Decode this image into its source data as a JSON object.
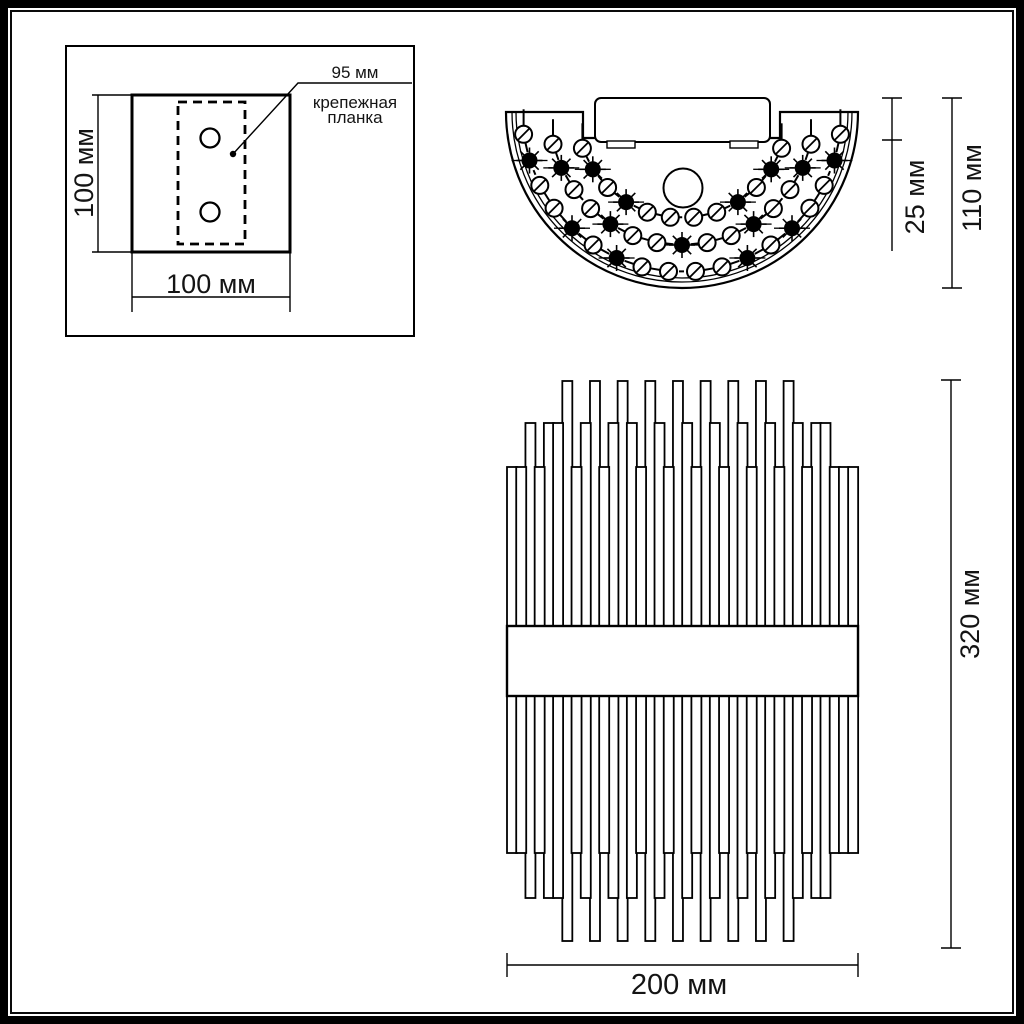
{
  "page": {
    "background": "#ffffff",
    "line_color": "#000000"
  },
  "mounting_plate_view": {
    "height_label": "100 мм",
    "width_label": "100 мм",
    "callout_value": "95 мм",
    "callout_label_line1": "крепежная",
    "callout_label_line2": "планка"
  },
  "top_view": {
    "box_depth_label": "25 мм",
    "total_depth_label": "110 мм"
  },
  "front_view": {
    "height_label": "320 мм",
    "width_label": "200 мм"
  }
}
